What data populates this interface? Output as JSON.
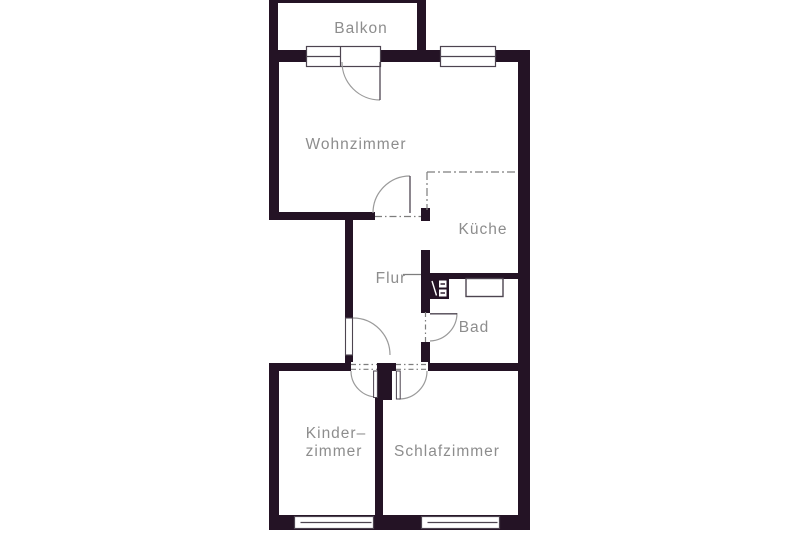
{
  "plan": {
    "type_label": "floor-plan",
    "rooms": {
      "balkon": {
        "label": "Balkon"
      },
      "wohnzimmer": {
        "label": "Wohnzimmer"
      },
      "kueche": {
        "label": "Küche"
      },
      "flur": {
        "label": "Flur"
      },
      "bad": {
        "label": "Bad"
      },
      "kinderzimmer": {
        "label_line1": "Kinder–",
        "label_line2": "zimmer"
      },
      "schlafzimmer": {
        "label": "Schlafzimmer"
      }
    }
  },
  "colors": {
    "wall": "#241325",
    "line": "#4d4450",
    "arc": "#9a9a9a",
    "dash": "#7d7d7d",
    "text": "#8d8d8d",
    "background": "#ffffff"
  }
}
